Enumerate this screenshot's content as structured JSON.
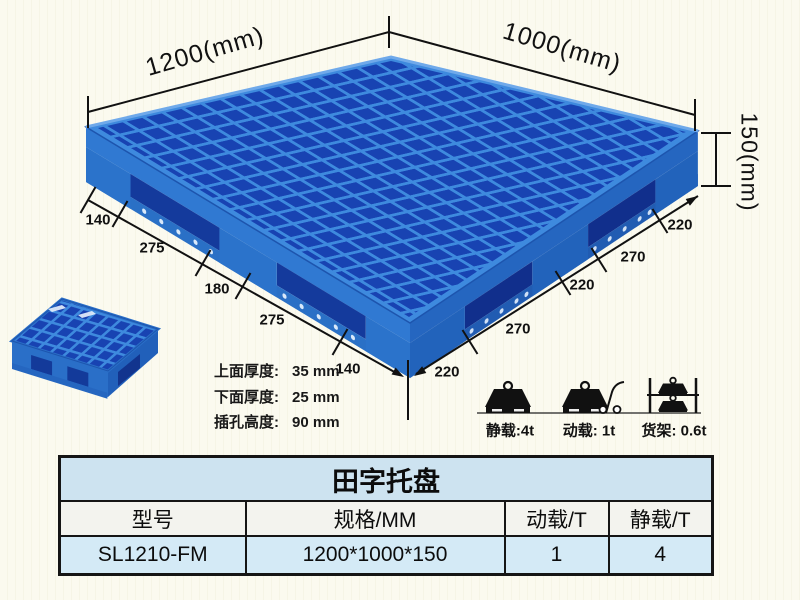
{
  "background": "#fafaf0",
  "colors": {
    "pallet_light": "#3e8ade",
    "pallet_mid": "#2f7bd4",
    "pallet_dark": "#1843b2",
    "table_title_bg": "#cde3f0",
    "table_header_bg": "#f3f3ee",
    "table_row_bg": "#d4eaf6"
  },
  "dimensions": {
    "length": "1200(mm)",
    "width": "1000(mm)",
    "height": "150(mm)",
    "left_chain": [
      "140",
      "275",
      "180",
      "275",
      "140"
    ],
    "right_chain": [
      "220",
      "270",
      "220",
      "270",
      "220"
    ]
  },
  "specs": {
    "lines": [
      {
        "label": "上面厚度:",
        "value": "35 mm"
      },
      {
        "label": "下面厚度:",
        "value": "25 mm"
      },
      {
        "label": "插孔高度:",
        "value": "90 mm"
      }
    ]
  },
  "loads": {
    "static_label": "静载:4t",
    "dynamic_label": "动载: 1t",
    "rack_label": "货架: 0.6t"
  },
  "table": {
    "title": "田字托盘",
    "headers": [
      "型号",
      "规格/MM",
      "动载/T",
      "静载/T"
    ],
    "rows": [
      [
        "SL1210-FM",
        "1200*1000*150",
        "1",
        "4"
      ]
    ]
  }
}
